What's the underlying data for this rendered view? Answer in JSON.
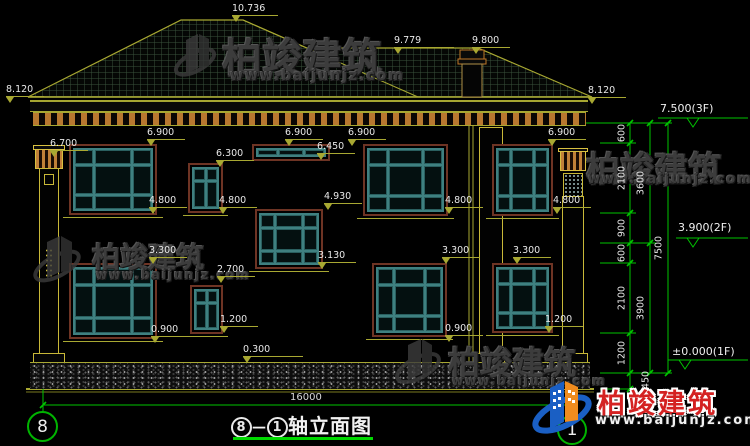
{
  "fdims": [
    "10.736",
    "9.779",
    "9.800",
    "8.120",
    "8.120",
    "6.700",
    "6.900",
    "6.300",
    "6.900",
    "6.450",
    "6.900",
    "6.900",
    "4.800",
    "4.800",
    "4.800",
    "4.800",
    "4.930",
    "3.130",
    "2.700",
    "1.200",
    "3.300",
    "0.900",
    "3.300",
    "0.900",
    "3.300",
    "1.200",
    "0.300"
  ],
  "levels": {
    "f3": "7.500(3F)",
    "f2": "3.900(2F)",
    "f1": "±0.000(1F)"
  },
  "vseg": [
    "600",
    "2100",
    "900",
    "600",
    "2100",
    "1200",
    "450"
  ],
  "vfloor": [
    "3600",
    "3900"
  ],
  "vtotal": "7500",
  "bottom_width": "16000",
  "axis": {
    "left": "8",
    "right": "1"
  },
  "title": {
    "a": "8",
    "dash": "—",
    "b": "1",
    "text": "轴立面图"
  },
  "watermark": {
    "brand": "柏竣建筑",
    "url": "www.baijunjz.com"
  },
  "logo": {
    "brand": "柏竣建筑",
    "url": "www.baijunjz.com"
  },
  "colors": {
    "dim_line": "#a8a832",
    "dim_green": "#00c400",
    "window_frame": "#3f8080",
    "window_trim": "#6e3424",
    "dentil": "#b87830",
    "text": "#e8e8e8",
    "logo_red": "#d42222",
    "logo_blue": "#1a5fc4",
    "logo_orange": "#f08c1e"
  }
}
